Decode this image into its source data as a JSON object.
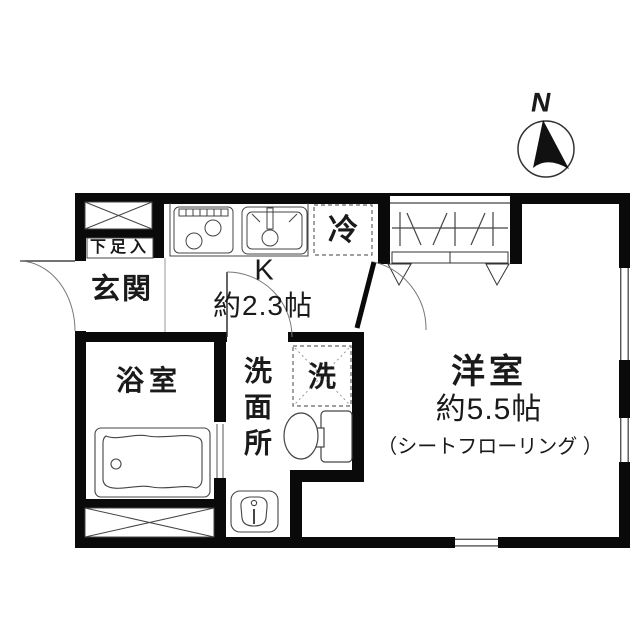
{
  "compass": {
    "north_label": "N"
  },
  "rooms": {
    "shoe_storage": {
      "label": "下足入"
    },
    "entrance": {
      "label": "玄関"
    },
    "kitchen": {
      "label": "K",
      "size": "約2.3帖"
    },
    "refrigerator": {
      "label": "冷"
    },
    "bathroom": {
      "label": "浴室"
    },
    "washroom": {
      "label": "洗面所"
    },
    "laundry_space": {
      "label": "洗"
    },
    "western_room": {
      "label": "洋室",
      "size": "約5.5帖",
      "flooring_note": "（シートフローリング ）"
    }
  },
  "fixtures": {
    "stove": "gas-stove-icon",
    "sink": "kitchen-sink-icon",
    "closet": "closet-hanger-icon",
    "bathtub": "bathtub-icon",
    "toilet": "toilet-icon",
    "washbasin": "washbasin-icon",
    "pipe_space_top": "crossed-box-icon",
    "pipe_space_bottom": "crossed-box-icon"
  },
  "colors": {
    "wall": "#0a0a0a",
    "thin_line": "#444444",
    "door_arc": "#777777",
    "background": "#ffffff",
    "text": "#1a1a1a"
  }
}
